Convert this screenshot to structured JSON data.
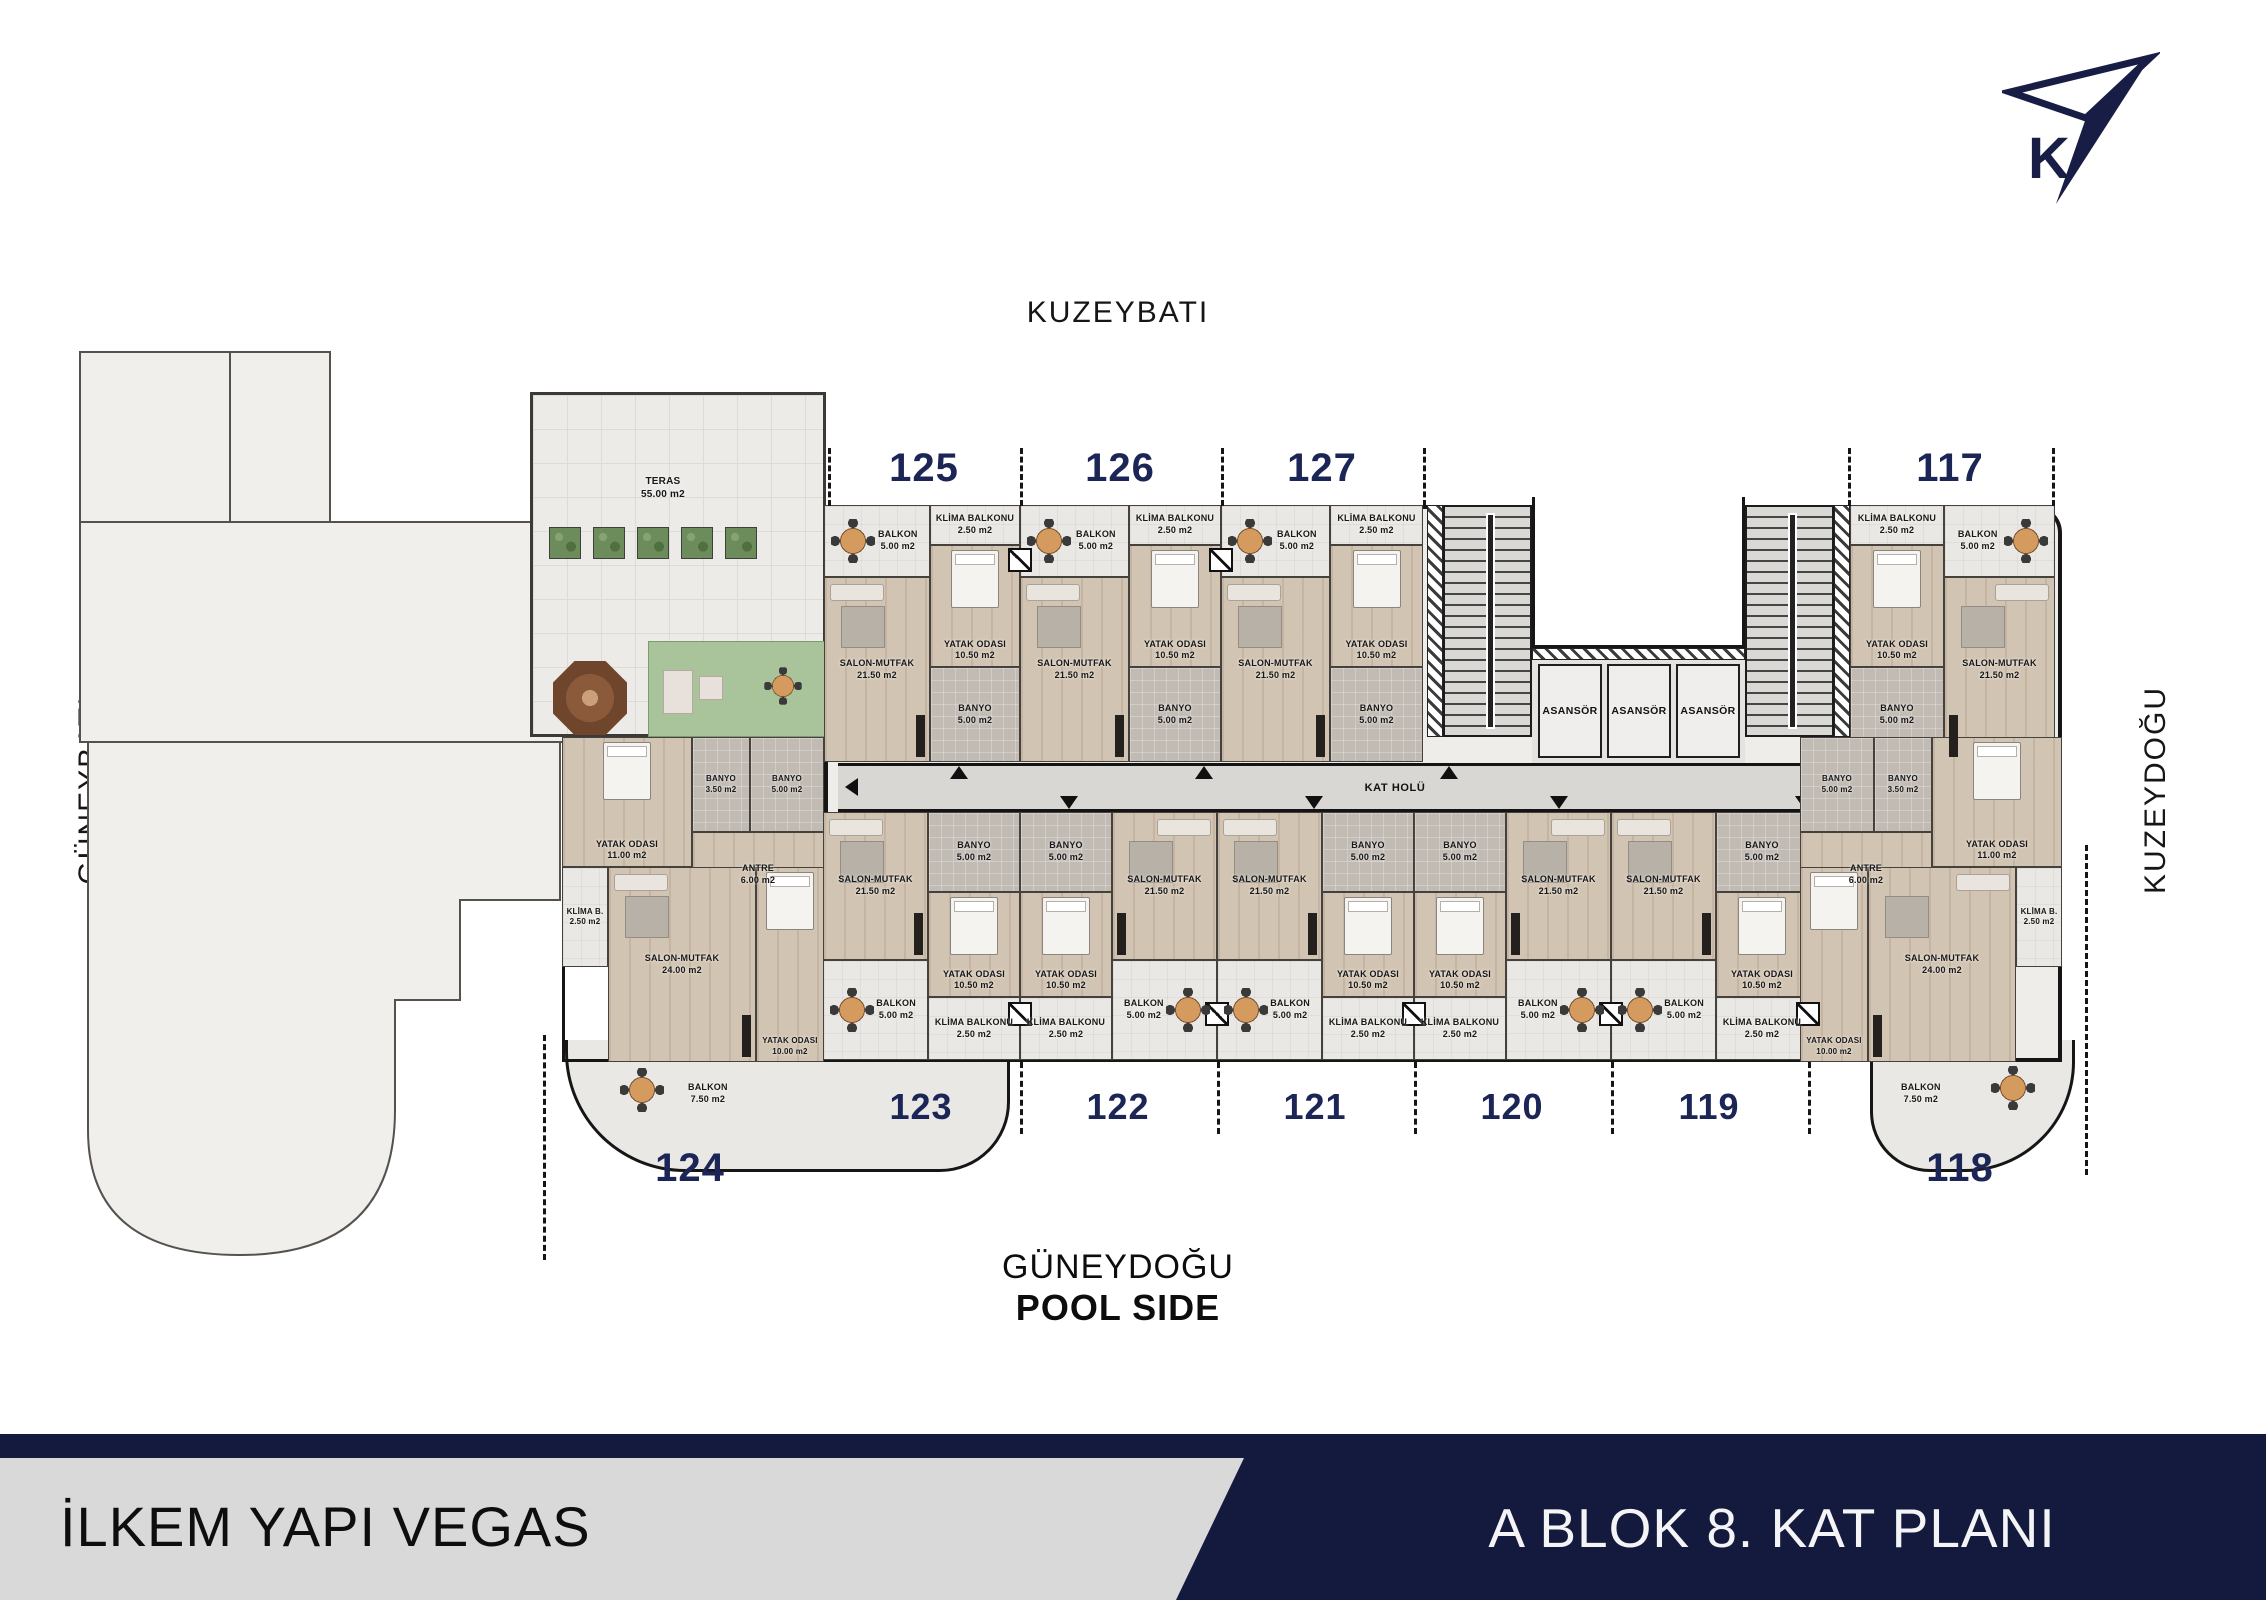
{
  "directions": {
    "top": "KUZEYBATI",
    "left": "GÜNEYBATI",
    "right": "KUZEYDOĞU",
    "bottom_line1": "GÜNEYDOĞU",
    "bottom_line2": "POOL SIDE",
    "compass_letter": "K"
  },
  "footer": {
    "project": "İLKEM YAPI VEGAS",
    "plan_title": "A BLOK 8. KAT PLANI"
  },
  "plan": {
    "corridor_label": "KAT HOLÜ",
    "elevator_label": "ASANSÖR",
    "terrace": {
      "name": "TERAS",
      "area": "55.00 m2"
    }
  },
  "units": {
    "top": [
      {
        "no": "125"
      },
      {
        "no": "126"
      },
      {
        "no": "127"
      },
      {
        "no": "117"
      }
    ],
    "bottom": [
      {
        "no": "123"
      },
      {
        "no": "122"
      },
      {
        "no": "121"
      },
      {
        "no": "120"
      },
      {
        "no": "119"
      }
    ],
    "corner": [
      {
        "no": "124"
      },
      {
        "no": "118"
      }
    ]
  },
  "room_types": {
    "standard": {
      "salon": {
        "name": "SALON-MUTFAK",
        "area": "21.50 m2"
      },
      "yatak": {
        "name": "YATAK ODASI",
        "area": "10.50 m2"
      },
      "banyo": {
        "name": "BANYO",
        "area": "5.00 m2"
      },
      "balkon": {
        "name": "BALKON",
        "area": "5.00 m2"
      },
      "klima": {
        "name": "KLİMA BALKONU",
        "area": "2.50 m2"
      }
    },
    "corner": {
      "yatak1": {
        "name": "YATAK ODASI",
        "area": "11.00 m2"
      },
      "banyo_small": {
        "name": "BANYO",
        "area": "3.50 m2"
      },
      "antre": {
        "name": "ANTRE",
        "area": "6.00 m2"
      },
      "banyo": {
        "name": "BANYO",
        "area": "5.00 m2"
      },
      "klima_b": {
        "name": "KLİMA B.",
        "area": "2.50 m2"
      },
      "salon": {
        "name": "SALON-MUTFAK",
        "area": "24.00 m2"
      },
      "yatak2": {
        "name": "YATAK ODASI",
        "area": "10.00 m2"
      },
      "balkon": {
        "name": "BALKON",
        "area": "7.50 m2"
      }
    }
  }
}
